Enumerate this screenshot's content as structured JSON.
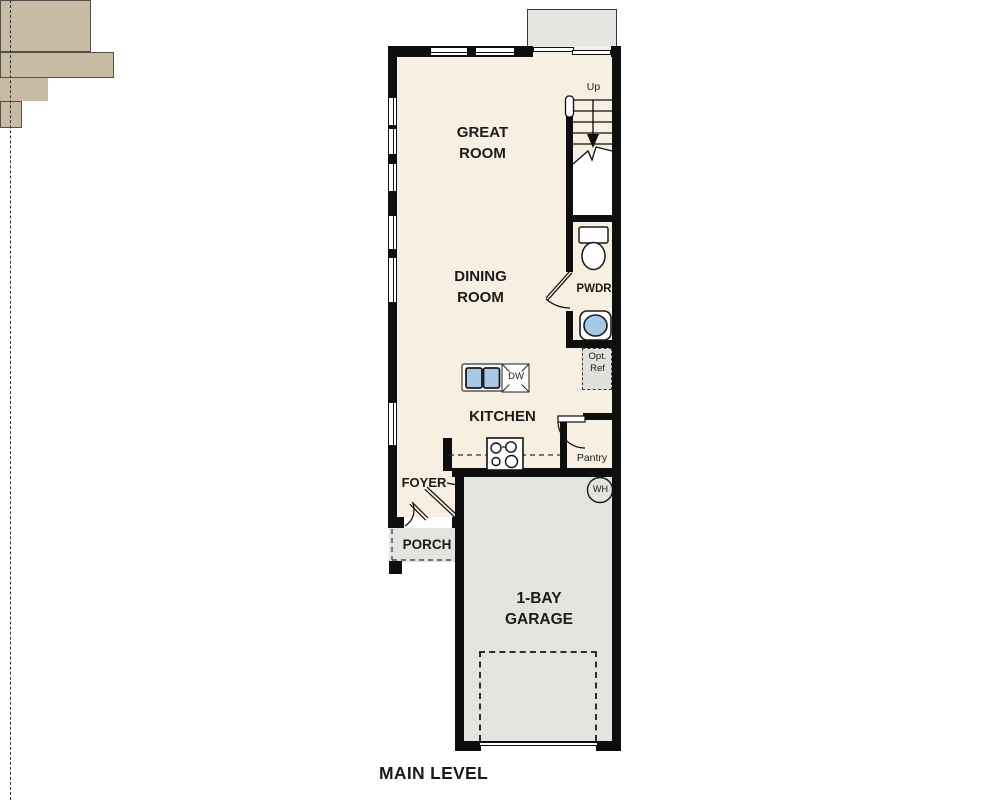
{
  "floor_plan": {
    "title": "MAIN LEVEL",
    "rooms": {
      "great_room": {
        "lines": [
          "GREAT",
          "ROOM"
        ]
      },
      "dining_room": {
        "lines": [
          "DINING",
          "ROOM"
        ]
      },
      "kitchen": {
        "label": "KITCHEN"
      },
      "foyer": {
        "label": "FOYER"
      },
      "porch": {
        "label": "PORCH"
      },
      "powder_room": {
        "label": "PWDR"
      },
      "pantry": {
        "label": "Pantry"
      },
      "garage": {
        "lines": [
          "1-BAY",
          "GARAGE"
        ]
      }
    },
    "annotations": {
      "stairs_direction": "Up",
      "dishwasher": "DW",
      "water_heater": "WH",
      "optional_refrigerator": {
        "lines": [
          "Opt.",
          "Ref"
        ]
      }
    },
    "colors": {
      "wall": "#0e0e0e",
      "interior_floor": "#f7efe2",
      "cabinetry": "#c8bba3",
      "garage_floor": "#e3e3e0",
      "deck": "#e5e5e2",
      "porch_floor": "#e3e3e0",
      "sink_fill": "#a8c9e5",
      "label_text": "#1b1b1b"
    }
  }
}
